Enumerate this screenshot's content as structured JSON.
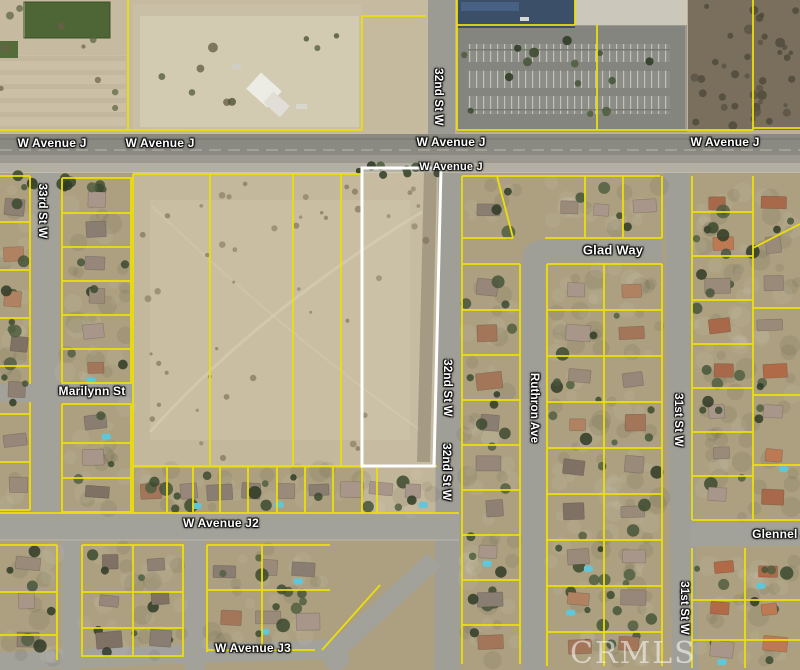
{
  "map": {
    "watermark": "CRMLS",
    "colors": {
      "parcel_line": "#ecdf08",
      "subject_parcel_outline": "#ffffff",
      "desert": "#c4b89c",
      "road": "#a09f98",
      "blue_building_roof": "#3b5068"
    },
    "street_labels": [
      {
        "id": "w-avenue-j-1",
        "text": "W Avenue J",
        "x": 52,
        "y": 143,
        "vertical": false,
        "size": 12
      },
      {
        "id": "w-avenue-j-2",
        "text": "W Avenue J",
        "x": 160,
        "y": 143,
        "vertical": false,
        "size": 12
      },
      {
        "id": "w-avenue-j-3",
        "text": "W Avenue J",
        "x": 451,
        "y": 142,
        "vertical": false,
        "size": 12
      },
      {
        "id": "w-avenue-j-4",
        "text": "W Avenue J",
        "x": 725,
        "y": 142,
        "vertical": false,
        "size": 12
      },
      {
        "id": "w-avenue-j-5",
        "text": "W Avenue J",
        "x": 451,
        "y": 167,
        "vertical": false,
        "size": 11
      },
      {
        "id": "32nd-st-w-1",
        "text": "32nd St W",
        "x": 438,
        "y": 97,
        "vertical": true,
        "size": 11.5
      },
      {
        "id": "32nd-st-w-2",
        "text": "32nd St W",
        "x": 447,
        "y": 388,
        "vertical": true,
        "size": 11.5
      },
      {
        "id": "32nd-st-w-3",
        "text": "32nd St W",
        "x": 446,
        "y": 472,
        "vertical": true,
        "size": 11.5
      },
      {
        "id": "33rd-st-w",
        "text": "33rd St W",
        "x": 42,
        "y": 211,
        "vertical": true,
        "size": 11.5
      },
      {
        "id": "marilynn-st",
        "text": "Marilynn St",
        "x": 92,
        "y": 391,
        "vertical": false,
        "size": 12
      },
      {
        "id": "glad-way",
        "text": "Glad Way",
        "x": 613,
        "y": 250,
        "vertical": false,
        "size": 13
      },
      {
        "id": "ruthron-ave",
        "text": "Ruthron Ave",
        "x": 534,
        "y": 408,
        "vertical": true,
        "size": 11.5
      },
      {
        "id": "31st-st-w-1",
        "text": "31st St W",
        "x": 678,
        "y": 420,
        "vertical": true,
        "size": 11.5
      },
      {
        "id": "31st-st-w-2",
        "text": "31st St W",
        "x": 684,
        "y": 608,
        "vertical": true,
        "size": 11.5
      },
      {
        "id": "w-avenue-j2",
        "text": "W Avenue J2",
        "x": 221,
        "y": 523,
        "vertical": false,
        "size": 12
      },
      {
        "id": "w-avenue-j3",
        "text": "W Avenue J3",
        "x": 253,
        "y": 648,
        "vertical": false,
        "size": 12
      },
      {
        "id": "glennel-ave",
        "text": "Glennel Av",
        "x": 784,
        "y": 534,
        "vertical": false,
        "size": 12
      }
    ]
  }
}
